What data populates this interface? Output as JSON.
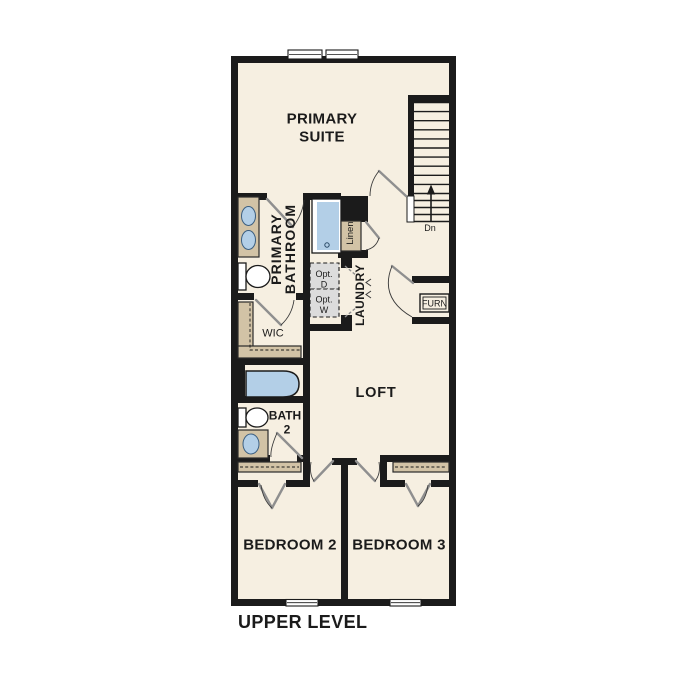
{
  "plan": {
    "title": "UPPER LEVEL",
    "type": "floor-plan"
  },
  "colors": {
    "background": "#ffffff",
    "floor": "#f6efe1",
    "wall": "#1b1b1b",
    "fixture_tan": "#d2c3a6",
    "water_blue": "#b3cfe7",
    "appliance_gray": "#dcdcdc",
    "door_gray": "#8f8f8f"
  },
  "rooms": {
    "primary_suite": {
      "line1": "PRIMARY",
      "line2": "SUITE"
    },
    "primary_bathroom": {
      "line1": "PRIMARY",
      "line2": "BATHROOM"
    },
    "wic": {
      "label": "WIC"
    },
    "linen": {
      "label": "Linen"
    },
    "laundry": {
      "label": "LAUNDRY"
    },
    "loft": {
      "label": "LOFT"
    },
    "bath2": {
      "line1": "BATH",
      "line2": "2"
    },
    "bedroom2": {
      "label": "BEDROOM 2"
    },
    "bedroom3": {
      "label": "BEDROOM 3"
    },
    "furnace": {
      "label": "FURN"
    }
  },
  "stairs": {
    "direction_label": "Dn"
  },
  "appliances": {
    "optional_dryer": {
      "line1": "Opt.",
      "line2": "D"
    },
    "optional_washer": {
      "line1": "Opt.",
      "line2": "W"
    }
  }
}
